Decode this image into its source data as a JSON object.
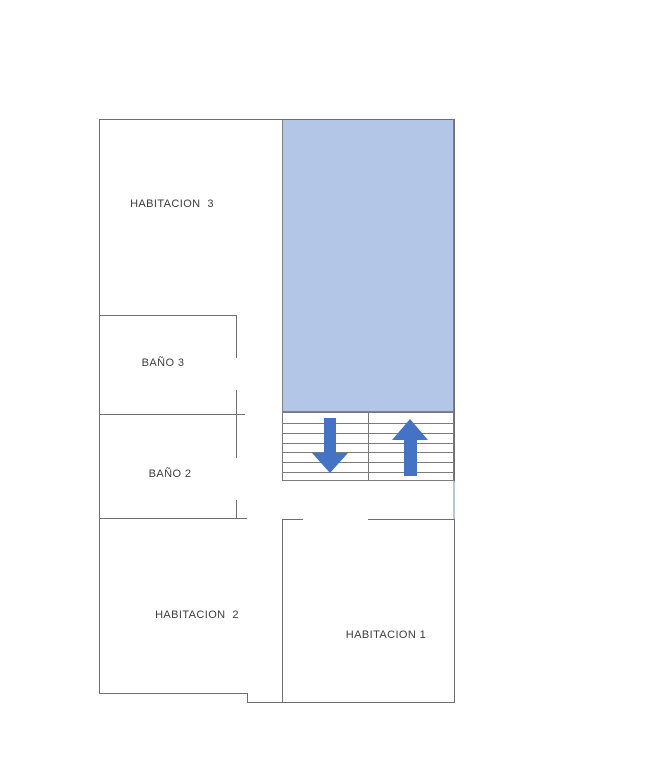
{
  "diagram": {
    "type": "floor-plan",
    "rooms": {
      "habitacion_3": {
        "label": "HABITACION  3"
      },
      "bano_3": {
        "label": "BAÑO 3"
      },
      "bano_2": {
        "label": "BAÑO 2"
      },
      "habitacion_2": {
        "label": "HABITACION  2"
      },
      "habitacion_1": {
        "label": "HABITACION 1"
      }
    },
    "stairs": {
      "columns": 2,
      "arrows": [
        "down",
        "up"
      ]
    }
  },
  "colors": {
    "background": "#ffffff",
    "wall": "#6e6e6e",
    "void_fill": "#b4c6e7",
    "arrow": "#4472c4",
    "text": "#3d3d3d"
  }
}
